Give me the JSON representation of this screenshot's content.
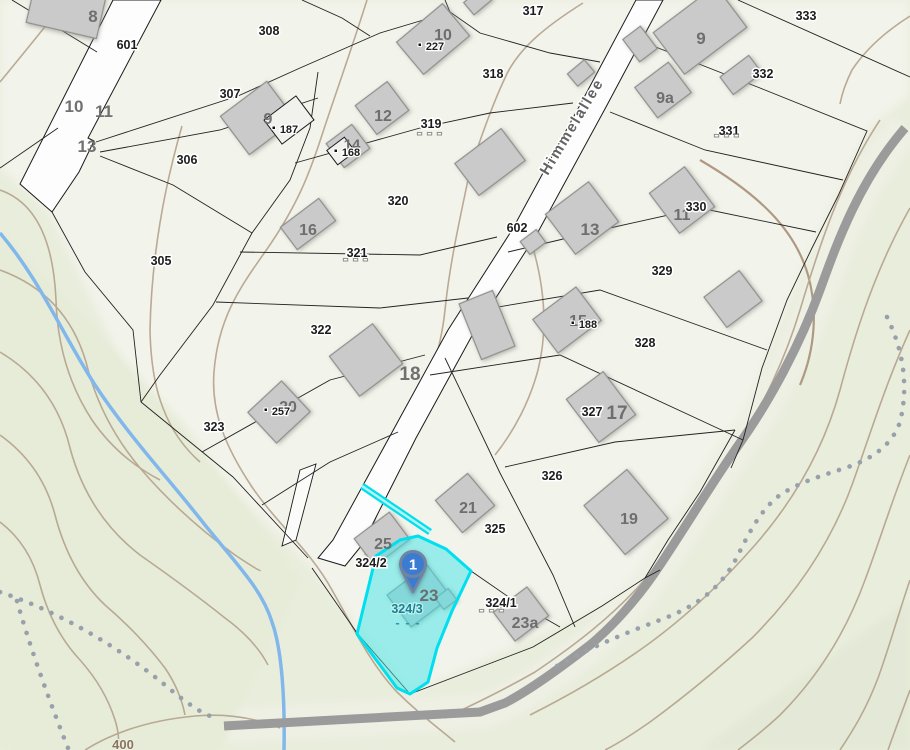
{
  "map": {
    "street": {
      "name": "Himmelallee",
      "x": 576,
      "y": 129,
      "rotation": -59
    },
    "marker": {
      "number": "1",
      "x": 413,
      "y": 564
    },
    "selected_parcel": {
      "id": "324/3",
      "x": 407,
      "y": 613
    },
    "colors": {
      "highlight_fill": "#40e5e8",
      "highlight_border": "#00dff0",
      "pin_fill": "#3b7cd2",
      "pin_border": "#6f84a0",
      "building_fill": "#cacaca",
      "road_fill": "#fdfdfd",
      "track_gray": "#9b9b9b",
      "stream_blue": "#82b7ec",
      "contour_brown": "#b4a28c",
      "selected_text": "#1f7f92"
    },
    "labels": {
      "parcels": [
        {
          "text": "601",
          "x": 127,
          "y": 45
        },
        {
          "text": "308",
          "x": 269,
          "y": 31
        },
        {
          "text": "317",
          "x": 533,
          "y": 11
        },
        {
          "text": "333",
          "x": 806,
          "y": 16
        },
        {
          "text": "307",
          "x": 230,
          "y": 94
        },
        {
          "text": "306",
          "x": 187,
          "y": 160
        },
        {
          "text": "305",
          "x": 161,
          "y": 261
        },
        {
          "text": "318",
          "x": 493,
          "y": 74
        },
        {
          "text": "319",
          "x": 431,
          "y": 124
        },
        {
          "text": "320",
          "x": 398,
          "y": 201
        },
        {
          "text": "321",
          "x": 357,
          "y": 253
        },
        {
          "text": "322",
          "x": 321,
          "y": 330
        },
        {
          "text": "323",
          "x": 214,
          "y": 427
        },
        {
          "text": "602",
          "x": 517,
          "y": 228
        },
        {
          "text": "332",
          "x": 763,
          "y": 74
        },
        {
          "text": "331",
          "x": 729,
          "y": 131
        },
        {
          "text": "330",
          "x": 696,
          "y": 207
        },
        {
          "text": "329",
          "x": 662,
          "y": 271
        },
        {
          "text": "328",
          "x": 645,
          "y": 343
        },
        {
          "text": "327",
          "x": 592,
          "y": 412
        },
        {
          "text": "326",
          "x": 552,
          "y": 476
        },
        {
          "text": "325",
          "x": 495,
          "y": 529
        },
        {
          "text": "324/2",
          "x": 371,
          "y": 563
        },
        {
          "text": "324/1",
          "x": 501,
          "y": 603
        }
      ],
      "annex": [
        {
          "text": "187",
          "x": 289,
          "y": 133
        },
        {
          "text": "168",
          "x": 351,
          "y": 156
        },
        {
          "text": "227",
          "x": 435,
          "y": 50
        },
        {
          "text": "188",
          "x": 588,
          "y": 328
        },
        {
          "text": "257",
          "x": 281,
          "y": 415
        }
      ],
      "houses": [
        {
          "text": "8",
          "x": 93,
          "y": 16,
          "size": 17
        },
        {
          "text": "10",
          "x": 74,
          "y": 106,
          "size": 17
        },
        {
          "text": "11",
          "x": 104,
          "y": 111,
          "size": 17
        },
        {
          "text": "13",
          "x": 87,
          "y": 146,
          "size": 17
        },
        {
          "text": "9",
          "x": 268,
          "y": 118,
          "size": 16
        },
        {
          "text": "12",
          "x": 383,
          "y": 115,
          "size": 16
        },
        {
          "text": "14",
          "x": 352,
          "y": 144,
          "size": 15
        },
        {
          "text": "10",
          "x": 443,
          "y": 34,
          "size": 16
        },
        {
          "text": "16",
          "x": 308,
          "y": 229,
          "size": 16
        },
        {
          "text": "9",
          "x": 701,
          "y": 38,
          "size": 17
        },
        {
          "text": "9a",
          "x": 665,
          "y": 97,
          "size": 16
        },
        {
          "text": "11",
          "x": 682,
          "y": 214,
          "size": 16
        },
        {
          "text": "13",
          "x": 590,
          "y": 229,
          "size": 17
        },
        {
          "text": "15",
          "x": 578,
          "y": 320,
          "size": 16
        },
        {
          "text": "18",
          "x": 410,
          "y": 373,
          "size": 19
        },
        {
          "text": "17",
          "x": 617,
          "y": 412,
          "size": 19
        },
        {
          "text": "20",
          "x": 288,
          "y": 406,
          "size": 16
        },
        {
          "text": "21",
          "x": 468,
          "y": 507,
          "size": 16
        },
        {
          "text": "19",
          "x": 629,
          "y": 518,
          "size": 16
        },
        {
          "text": "23",
          "x": 429,
          "y": 595,
          "size": 17
        },
        {
          "text": "23a",
          "x": 525,
          "y": 622,
          "size": 16
        },
        {
          "text": "25",
          "x": 383,
          "y": 543,
          "size": 16
        }
      ],
      "dashes": [
        {
          "text": "- - -",
          "x": 430,
          "y": 137,
          "color": "#fdfdfd"
        },
        {
          "text": "- - -",
          "x": 356,
          "y": 263,
          "color": "#fdfdfd"
        },
        {
          "text": "- - -",
          "x": 727,
          "y": 139,
          "color": "#fdfdfd"
        },
        {
          "text": "- - -",
          "x": 492,
          "y": 614,
          "color": "#fdfdfd"
        },
        {
          "text": "- - -",
          "x": 408,
          "y": 627,
          "color": "#2e9aa8"
        }
      ],
      "contour": {
        "text": "400",
        "x": 123,
        "y": 749
      }
    }
  }
}
